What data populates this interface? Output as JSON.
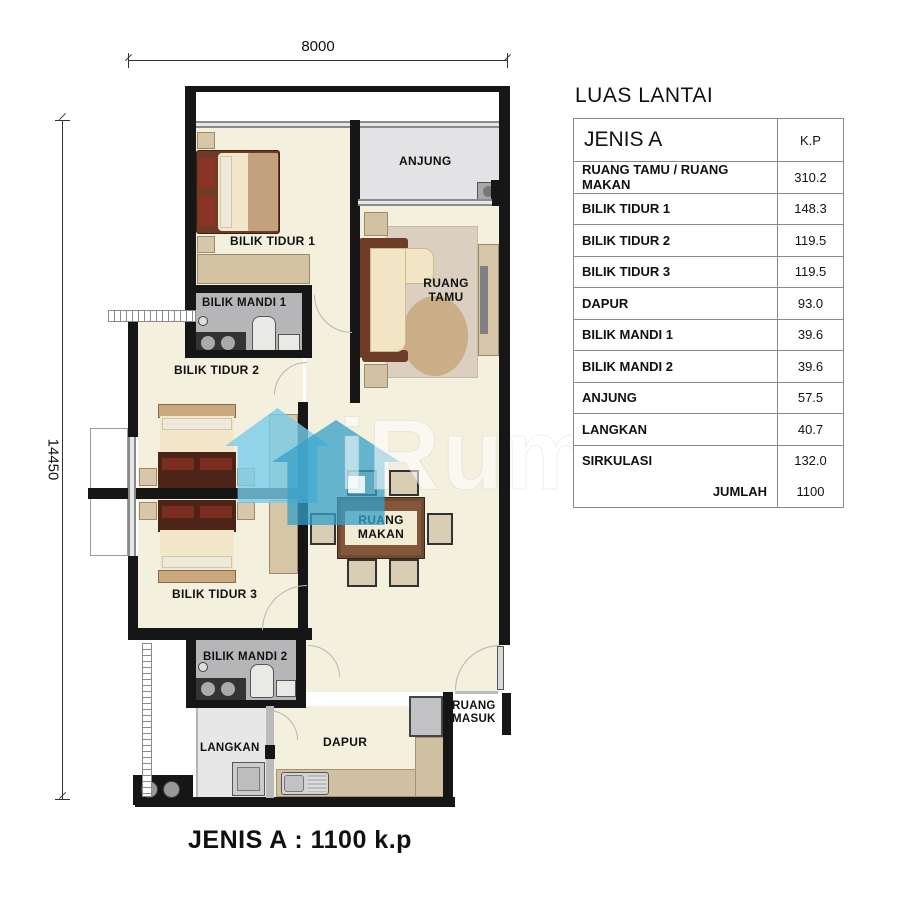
{
  "dimensions": {
    "top": "8000",
    "left": "14450"
  },
  "plan": {
    "labels": {
      "anjung": "ANJUNG",
      "bilik_tidur_1": "BILIK TIDUR 1",
      "bilik_mandi_1": "BILIK MANDI 1",
      "ruang_tamu": "RUANG TAMU",
      "bilik_tidur_2": "BILIK TIDUR 2",
      "ruang_makan": "RUANG MAKAN",
      "bilik_tidur_3": "BILIK TIDUR 3",
      "bilik_mandi_2": "BILIK MANDI 2",
      "langkan": "LANGKAN",
      "dapur": "DAPUR",
      "ruang_masuk": "RUANG MASUK"
    }
  },
  "watermark": {
    "text": "iRumah",
    "accent_color": "#45b8dc"
  },
  "floor_area_table": {
    "title": "LUAS LANTAI",
    "type_header": "JENIS A",
    "unit_header": "K.P",
    "rows": [
      {
        "label": "RUANG TAMU / RUANG MAKAN",
        "value": "310.2"
      },
      {
        "label": "BILIK TIDUR 1",
        "value": "148.3"
      },
      {
        "label": "BILIK TIDUR 2",
        "value": "119.5"
      },
      {
        "label": "BILIK TIDUR 3",
        "value": "119.5"
      },
      {
        "label": "DAPUR",
        "value": "93.0"
      },
      {
        "label": "BILIK MANDI 1",
        "value": "39.6"
      },
      {
        "label": "BILIK MANDI 2",
        "value": "39.6"
      },
      {
        "label": "ANJUNG",
        "value": "57.5"
      },
      {
        "label": "LANGKAN",
        "value": "40.7"
      },
      {
        "label": "SIRKULASI",
        "value": "132.0"
      }
    ],
    "total_label": "JUMLAH",
    "total_value": "1100"
  },
  "caption": "JENIS A : 1100 k.p"
}
